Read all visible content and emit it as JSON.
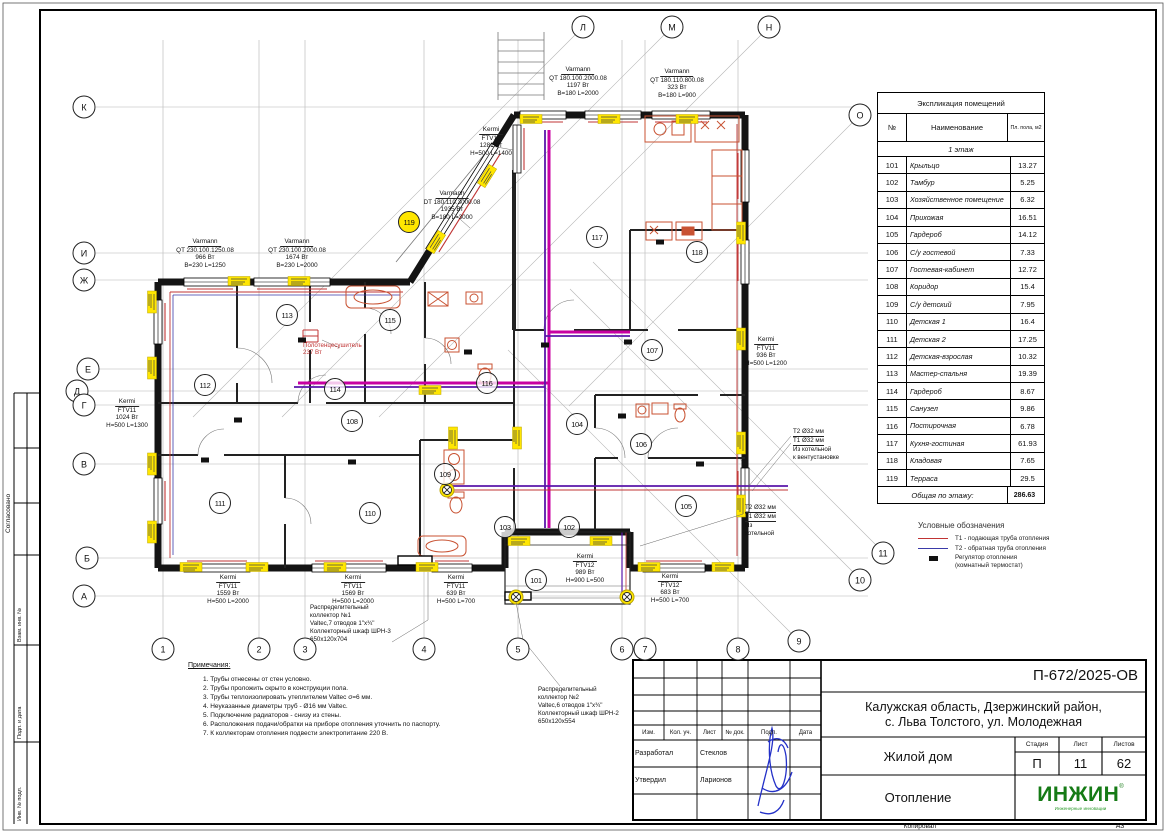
{
  "sheet": {
    "doc_number": "П-672/2025-ОВ",
    "address_line1": "Калужская область, Дзержинский район,",
    "address_line2": "с. Льва Толстого, ул. Молодежная",
    "object_name": "Жилой дом",
    "stage_label": "Стадия",
    "sheet_label": "Лист",
    "sheets_label": "Листов",
    "stage": "П",
    "sheet_no": "11",
    "sheets_total": "62",
    "section_title": "Отопление",
    "logo": "ИНЖИН",
    "logo_reg": "®",
    "logo_sub": "Инженерные инновации",
    "copied_label": "Копировал",
    "format_label": "А3"
  },
  "stamp": {
    "headers": [
      "Изм.",
      "Кол. уч.",
      "Лист",
      "№ док.",
      "Подп.",
      "Дата"
    ],
    "row1_role": "Разработал",
    "row1_name": "Стеклов",
    "row2_role": "Утвердил",
    "row2_name": "Ларионов"
  },
  "margin": {
    "agreed": "Согласовано",
    "labels": [
      "Взам. инв. №",
      "Подп. и дата",
      "Инв. № подл."
    ]
  },
  "room_table": {
    "title": "Экспликация помещений",
    "col_no": "№",
    "col_name": "Наименование",
    "col_area": "Пл. пола, м2",
    "section": "1 этаж",
    "rows": [
      [
        "101",
        "Крыльцо",
        "13.27"
      ],
      [
        "102",
        "Тамбур",
        "5.25"
      ],
      [
        "103",
        "Хозяйственное помещение",
        "6.32"
      ],
      [
        "104",
        "Прихожая",
        "16.51"
      ],
      [
        "105",
        "Гардероб",
        "14.12"
      ],
      [
        "106",
        "С/у гостевой",
        "7.33"
      ],
      [
        "107",
        "Гостевая-кабинет",
        "12.72"
      ],
      [
        "108",
        "Коридор",
        "15.4"
      ],
      [
        "109",
        "С/у детский",
        "7.95"
      ],
      [
        "110",
        "Детская 1",
        "16.4"
      ],
      [
        "111",
        "Детская 2",
        "17.25"
      ],
      [
        "112",
        "Детская-взрослая",
        "10.32"
      ],
      [
        "113",
        "Мастер-спальня",
        "19.39"
      ],
      [
        "114",
        "Гардероб",
        "8.67"
      ],
      [
        "115",
        "Санузел",
        "9.86"
      ],
      [
        "116",
        "Постирочная",
        "6.78"
      ],
      [
        "117",
        "Кухня-гостиная",
        "61.93"
      ],
      [
        "118",
        "Кладовая",
        "7.65"
      ],
      [
        "119",
        "Терраса",
        "29.5"
      ]
    ],
    "total_label": "Общая по этажу:",
    "total": "286.63"
  },
  "legend": {
    "title": "Условные обозначения",
    "items": [
      {
        "sw": "line",
        "color": "#c03434",
        "text": "Т1 - подающая труба отопления"
      },
      {
        "sw": "line",
        "color": "#3a3aa8",
        "text": "Т2 - обратная труба отопления"
      },
      {
        "sw": "rect",
        "color": "#111111",
        "text": "Регулятор отопления",
        "text2": "(комнатный термостат)"
      }
    ]
  },
  "notes": {
    "title": "Примечания:",
    "items": [
      "Трубы отнесены от стен условно.",
      "Трубы проложить скрыто в конструкции пола.",
      "Трубы теплоизолировать утеплителем Valtec σ=6 мм.",
      "Неуказанные диаметры труб - Ø16 мм Valtec.",
      "Подключение радиаторов - снизу из стены.",
      "Расположения подачи/обратки на приборе отопления уточнить по паспорту.",
      "К коллекторам отопления подвести электропитание 220 В."
    ]
  },
  "plan": {
    "radiators": [
      {
        "cx": 205,
        "top": 238,
        "lines": [
          "Varmann",
          "QT 230.100.1250.08",
          "966 Вт",
          "B=230 L=1250"
        ]
      },
      {
        "cx": 297,
        "top": 238,
        "lines": [
          "Varmann",
          "QT 230.100.2000.08",
          "1674 Вт",
          "B=230 L=2000"
        ]
      },
      {
        "cx": 578,
        "top": 66,
        "lines": [
          "Varmann",
          "QT 180.100.2000.08",
          "1197 Вт",
          "B=180 L=2000"
        ]
      },
      {
        "cx": 677,
        "top": 68,
        "lines": [
          "Varmann",
          "QT 180.110.800.08",
          "323 Вт",
          "B=180 L=900"
        ]
      },
      {
        "cx": 491,
        "top": 126,
        "lines": [
          "Kermi",
          "FTV12",
          "1281 Вт",
          "H=500 L=1400"
        ]
      },
      {
        "cx": 452,
        "top": 190,
        "lines": [
          "Varmann",
          "DT 180.110.3000.08",
          "1935 Вт",
          "B=180 L=3000"
        ]
      },
      {
        "cx": 127,
        "top": 398,
        "lines": [
          "Kermi",
          "FTV11",
          "1024 Вт",
          "H=500 L=1300"
        ]
      },
      {
        "cx": 766,
        "top": 336,
        "lines": [
          "Kermi",
          "FTV11",
          "936 Вт",
          "H=500 L=1200"
        ]
      },
      {
        "cx": 228,
        "top": 574,
        "lines": [
          "Kermi",
          "FTV11",
          "1559 Вт",
          "H=500 L=2000"
        ]
      },
      {
        "cx": 353,
        "top": 574,
        "lines": [
          "Kermi",
          "FTV11",
          "1569 Вт",
          "H=500 L=2000"
        ]
      },
      {
        "cx": 456,
        "top": 574,
        "lines": [
          "Kermi",
          "FTV11",
          "639 Вт",
          "H=500 L=700"
        ]
      },
      {
        "cx": 585,
        "top": 553,
        "lines": [
          "Kermi",
          "FTV12",
          "989 Вт",
          "H=900 L=500"
        ]
      },
      {
        "cx": 670,
        "top": 573,
        "lines": [
          "Kermi",
          "FTV12",
          "683 Вт",
          "H=500 L=700"
        ]
      }
    ],
    "collectors": [
      {
        "left": 310,
        "top": 604,
        "lines": [
          "Распределительный",
          "коллектор №1",
          "Valtec,7 отводов 1\"х¾\"",
          "Коллекторный шкаф  ШРН-3",
          "650х120х704"
        ]
      },
      {
        "left": 538,
        "top": 686,
        "lines": [
          "Распределительный",
          "коллектор №2",
          "Valtec,6 отводов 1\"х¾\"",
          "Коллекторный шкаф ШРН-2",
          "650х120х554"
        ]
      }
    ],
    "pipe_notes": [
      {
        "left": 793,
        "top": 428,
        "u": 2,
        "lines": [
          "Т2  Ø32 мм",
          "Т1 Ø32 мм",
          "Из котельной",
          "к вентустановке"
        ]
      },
      {
        "left": 745,
        "top": 504,
        "u": 2,
        "lines": [
          "Т2  Ø32 мм",
          "Т1 Ø32 мм",
          "Из",
          "котельной"
        ]
      }
    ],
    "towel": {
      "left": 303,
      "top": 342,
      "lines": [
        "Полотенцесушитель",
        "237 Вт"
      ]
    },
    "rooms": [
      {
        "n": "101",
        "x": 536,
        "y": 580
      },
      {
        "n": "102",
        "x": 569,
        "y": 527
      },
      {
        "n": "103",
        "x": 505,
        "y": 527
      },
      {
        "n": "104",
        "x": 577,
        "y": 424
      },
      {
        "n": "105",
        "x": 686,
        "y": 506
      },
      {
        "n": "106",
        "x": 641,
        "y": 444
      },
      {
        "n": "107",
        "x": 652,
        "y": 350
      },
      {
        "n": "108",
        "x": 352,
        "y": 421
      },
      {
        "n": "109",
        "x": 445,
        "y": 474
      },
      {
        "n": "110",
        "x": 370,
        "y": 513
      },
      {
        "n": "111",
        "x": 220,
        "y": 503
      },
      {
        "n": "112",
        "x": 205,
        "y": 385
      },
      {
        "n": "113",
        "x": 287,
        "y": 315
      },
      {
        "n": "114",
        "x": 335,
        "y": 389
      },
      {
        "n": "115",
        "x": 390,
        "y": 320
      },
      {
        "n": "116",
        "x": 487,
        "y": 383
      },
      {
        "n": "117",
        "x": 597,
        "y": 237
      },
      {
        "n": "118",
        "x": 697,
        "y": 252
      },
      {
        "n": "119",
        "x": 409,
        "y": 222,
        "hl": true
      }
    ],
    "bubbles": [
      {
        "l": "К",
        "x": 84,
        "y": 107
      },
      {
        "l": "И",
        "x": 84,
        "y": 253
      },
      {
        "l": "Ж",
        "x": 84,
        "y": 280
      },
      {
        "l": "Е",
        "x": 88,
        "y": 369
      },
      {
        "l": "Д",
        "x": 77,
        "y": 391
      },
      {
        "l": "Г",
        "x": 84,
        "y": 405
      },
      {
        "l": "В",
        "x": 84,
        "y": 464
      },
      {
        "l": "Б",
        "x": 87,
        "y": 558
      },
      {
        "l": "А",
        "x": 84,
        "y": 596
      },
      {
        "l": "Л",
        "x": 583,
        "y": 27
      },
      {
        "l": "М",
        "x": 672,
        "y": 27
      },
      {
        "l": "Н",
        "x": 769,
        "y": 27
      },
      {
        "l": "О",
        "x": 860,
        "y": 115
      },
      {
        "l": "1",
        "x": 163,
        "y": 649
      },
      {
        "l": "2",
        "x": 259,
        "y": 649
      },
      {
        "l": "3",
        "x": 305,
        "y": 649
      },
      {
        "l": "4",
        "x": 424,
        "y": 649
      },
      {
        "l": "5",
        "x": 518,
        "y": 649
      },
      {
        "l": "6",
        "x": 622,
        "y": 649
      },
      {
        "l": "7",
        "x": 645,
        "y": 649
      },
      {
        "l": "8",
        "x": 738,
        "y": 649
      },
      {
        "l": "9",
        "x": 799,
        "y": 641
      },
      {
        "l": "10",
        "x": 860,
        "y": 580
      },
      {
        "l": "11",
        "x": 883,
        "y": 553
      }
    ]
  }
}
